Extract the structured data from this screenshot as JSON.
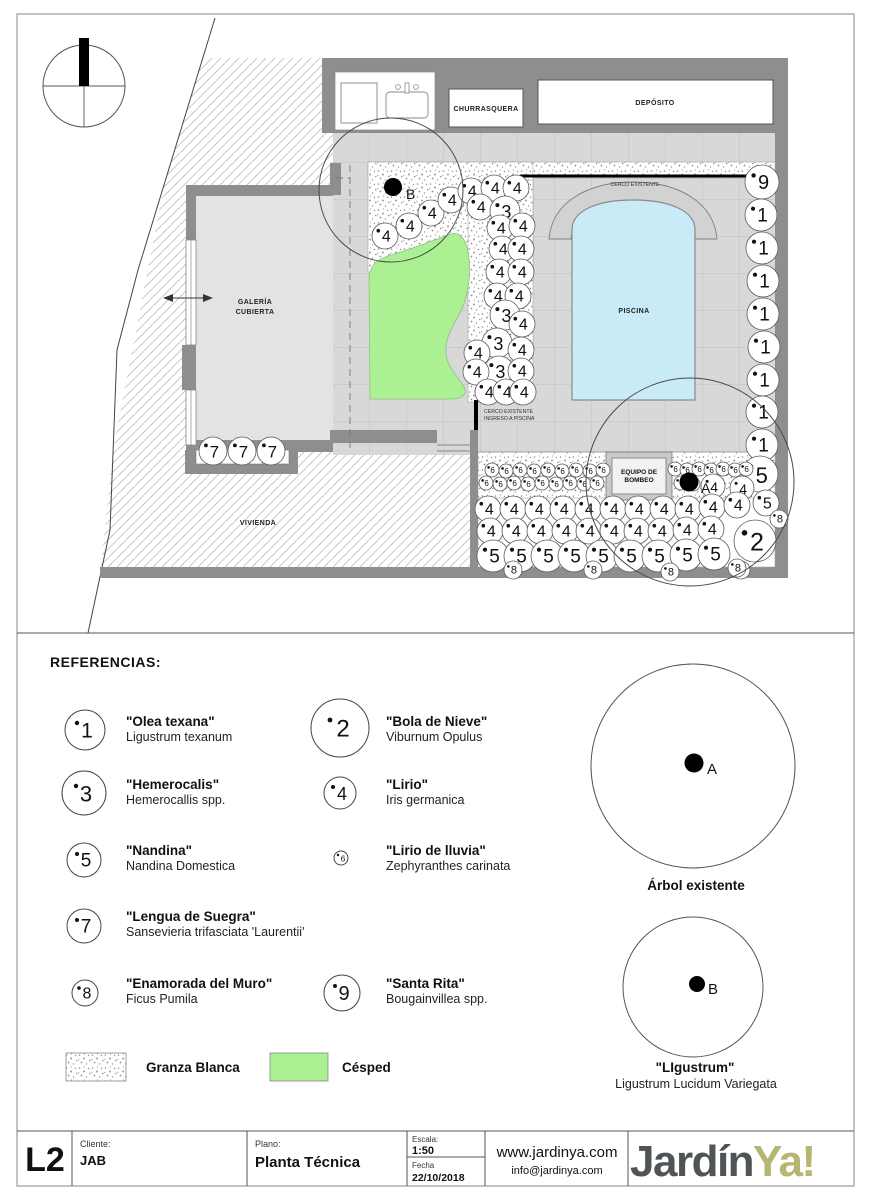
{
  "page": {
    "referencias_title": "REFERENCIAS:"
  },
  "colors": {
    "lawn": "#abf194",
    "pool": "#c9ebf7",
    "wall": "#8e8e8e",
    "paving": "#d8d8d8",
    "logo_dark": "#4f5457",
    "logo_olive": "#b6b672"
  },
  "plan": {
    "labels": {
      "churrasquera": "CHURRASQUERA",
      "deposito": "DEPÓSITO",
      "galeria_1": "GALERÍA",
      "galeria_2": "CUBIERTA",
      "vivienda": "VIVIENDA",
      "piscina": "PISCINA",
      "cerco_existente": "CERCO EXISTENTE",
      "ingreso_1": "CERCO EXISTENTE",
      "ingreso_2": "INGRESO A PISCINA",
      "equipo_1": "EQUIPO DE",
      "equipo_2": "BOMBEO",
      "tree_a": "A",
      "tree_b": "B"
    },
    "plants": [
      [
        762,
        182,
        17,
        "9"
      ],
      [
        761,
        215,
        16,
        "1"
      ],
      [
        762,
        248,
        16,
        "1"
      ],
      [
        763,
        281,
        16,
        "1"
      ],
      [
        763,
        314,
        16,
        "1"
      ],
      [
        764,
        347,
        16,
        "1"
      ],
      [
        763,
        380,
        16,
        "1"
      ],
      [
        762,
        412,
        16,
        "1"
      ],
      [
        762,
        445,
        16,
        "1"
      ],
      [
        760,
        474,
        18,
        "5"
      ],
      [
        766,
        503,
        13,
        "5"
      ],
      [
        779,
        519,
        9,
        "8"
      ],
      [
        755,
        541,
        21,
        "2"
      ],
      [
        741,
        570,
        9,
        "8"
      ],
      [
        385,
        236,
        13,
        "4"
      ],
      [
        409,
        226,
        13,
        "4"
      ],
      [
        431,
        213,
        13,
        "4"
      ],
      [
        451,
        200,
        13,
        "4"
      ],
      [
        471,
        191,
        13,
        "4"
      ],
      [
        494,
        188,
        13,
        "4"
      ],
      [
        516,
        188,
        13,
        "4"
      ],
      [
        480,
        207,
        13,
        "4"
      ],
      [
        505,
        211,
        15,
        "3"
      ],
      [
        500,
        228,
        13,
        "4"
      ],
      [
        522,
        226,
        13,
        "4"
      ],
      [
        502,
        249,
        13,
        "4"
      ],
      [
        521,
        249,
        13,
        "4"
      ],
      [
        499,
        272,
        13,
        "4"
      ],
      [
        521,
        272,
        13,
        "4"
      ],
      [
        497,
        296,
        13,
        "4"
      ],
      [
        518,
        296,
        13,
        "4"
      ],
      [
        505,
        315,
        15,
        "3"
      ],
      [
        522,
        324,
        13,
        "4"
      ],
      [
        497,
        343,
        15,
        "3"
      ],
      [
        521,
        350,
        13,
        "4"
      ],
      [
        477,
        353,
        13,
        "4"
      ],
      [
        499,
        371,
        15,
        "3"
      ],
      [
        521,
        371,
        13,
        "4"
      ],
      [
        476,
        372,
        13,
        "4"
      ],
      [
        488,
        392,
        13,
        "4"
      ],
      [
        506,
        392,
        13,
        "4"
      ],
      [
        523,
        392,
        13,
        "4"
      ],
      [
        492,
        470,
        7,
        "6"
      ],
      [
        506,
        471,
        7,
        "6"
      ],
      [
        520,
        470,
        7,
        "6"
      ],
      [
        534,
        471,
        7,
        "6"
      ],
      [
        548,
        470,
        7,
        "6"
      ],
      [
        562,
        471,
        7,
        "6"
      ],
      [
        576,
        470,
        7,
        "6"
      ],
      [
        590,
        471,
        7,
        "6"
      ],
      [
        603,
        470,
        7,
        "6"
      ],
      [
        486,
        483,
        7,
        "6"
      ],
      [
        500,
        484,
        7,
        "6"
      ],
      [
        514,
        483,
        7,
        "6"
      ],
      [
        528,
        484,
        7,
        "6"
      ],
      [
        542,
        483,
        7,
        "6"
      ],
      [
        556,
        484,
        7,
        "6"
      ],
      [
        570,
        483,
        7,
        "6"
      ],
      [
        584,
        484,
        7,
        "6"
      ],
      [
        597,
        483,
        7,
        "6"
      ],
      [
        675,
        469,
        7,
        "6"
      ],
      [
        687,
        470,
        7,
        "6"
      ],
      [
        699,
        469,
        7,
        "6"
      ],
      [
        711,
        470,
        7,
        "6"
      ],
      [
        723,
        469,
        7,
        "6"
      ],
      [
        735,
        470,
        7,
        "6"
      ],
      [
        746,
        469,
        7,
        "6"
      ],
      [
        681,
        483,
        7,
        "6"
      ],
      [
        693,
        484,
        7,
        "6"
      ],
      [
        713,
        486,
        12,
        "4"
      ],
      [
        742,
        488,
        12,
        "4"
      ],
      [
        488,
        509,
        13,
        "4"
      ],
      [
        513,
        509,
        13,
        "4"
      ],
      [
        538,
        509,
        13,
        "4"
      ],
      [
        563,
        509,
        13,
        "4"
      ],
      [
        588,
        509,
        13,
        "4"
      ],
      [
        613,
        509,
        13,
        "4"
      ],
      [
        638,
        509,
        13,
        "4"
      ],
      [
        663,
        509,
        13,
        "4"
      ],
      [
        688,
        509,
        13,
        "4"
      ],
      [
        712,
        507,
        13,
        "4"
      ],
      [
        737,
        505,
        13,
        "4"
      ],
      [
        490,
        531,
        13,
        "4"
      ],
      [
        515,
        531,
        13,
        "4"
      ],
      [
        540,
        531,
        13,
        "4"
      ],
      [
        565,
        531,
        13,
        "4"
      ],
      [
        589,
        531,
        13,
        "4"
      ],
      [
        613,
        531,
        13,
        "4"
      ],
      [
        637,
        531,
        13,
        "4"
      ],
      [
        661,
        531,
        13,
        "4"
      ],
      [
        686,
        530,
        13,
        "4"
      ],
      [
        711,
        529,
        13,
        "4"
      ],
      [
        493,
        556,
        16,
        "5"
      ],
      [
        520,
        556,
        16,
        "5"
      ],
      [
        547,
        556,
        16,
        "5"
      ],
      [
        574,
        556,
        16,
        "5"
      ],
      [
        602,
        556,
        16,
        "5"
      ],
      [
        630,
        556,
        16,
        "5"
      ],
      [
        658,
        556,
        16,
        "5"
      ],
      [
        686,
        555,
        16,
        "5"
      ],
      [
        714,
        554,
        16,
        "5"
      ],
      [
        513,
        570,
        9,
        "8"
      ],
      [
        593,
        570,
        9,
        "8"
      ],
      [
        670,
        572,
        9,
        "8"
      ],
      [
        737,
        568,
        9,
        "8"
      ],
      [
        213,
        451,
        14,
        "7"
      ],
      [
        242,
        451,
        14,
        "7"
      ],
      [
        271,
        451,
        14,
        "7"
      ]
    ]
  },
  "legend": {
    "items": [
      {
        "num": "1",
        "title": "\"Olea texana\"",
        "sub": "Ligustrum texanum"
      },
      {
        "num": "3",
        "title": "\"Hemerocalis\"",
        "sub": "Hemerocallis spp."
      },
      {
        "num": "5",
        "title": "\"Nandina\"",
        "sub": "Nandina Domestica"
      },
      {
        "num": "7",
        "title": "\"Lengua de Suegra\"",
        "sub": "Sansevieria trifasciata 'Laurentii'"
      },
      {
        "num": "8",
        "title": "\"Enamorada del Muro\"",
        "sub": "Ficus Pumila"
      },
      {
        "num": "2",
        "title": "\"Bola de Nieve\"",
        "sub": "Viburnum Opulus"
      },
      {
        "num": "4",
        "title": "\"Lirio\"",
        "sub": "Iris germanica"
      },
      {
        "num": "6",
        "title": "\"Lirio de lluvia\"",
        "sub": "Zephyranthes carinata"
      },
      {
        "num": "9",
        "title": "\"Santa Rita\"",
        "sub": "Bougainvillea spp."
      }
    ],
    "swatches": [
      {
        "label": "Granza Blanca"
      },
      {
        "label": "Césped"
      }
    ],
    "trees": [
      {
        "letter": "A",
        "caption": "Árbol existente"
      },
      {
        "letter": "B",
        "caption": "\"LIgustrum\"",
        "sub": "Ligustrum Lucidum Variegata"
      }
    ]
  },
  "titleblock": {
    "sheet": "L2",
    "cliente_label": "Cliente:",
    "cliente": "JAB",
    "plano_label": "Plano:",
    "plano": "Planta Técnica",
    "escala_label": "Escala:",
    "escala": "1:50",
    "fecha_label": "Fecha",
    "fecha": "22/10/2018",
    "web": "www.jardinya.com",
    "email": "info@jardinya.com",
    "logo_part1": "Jardín",
    "logo_part2": "Ya!"
  }
}
